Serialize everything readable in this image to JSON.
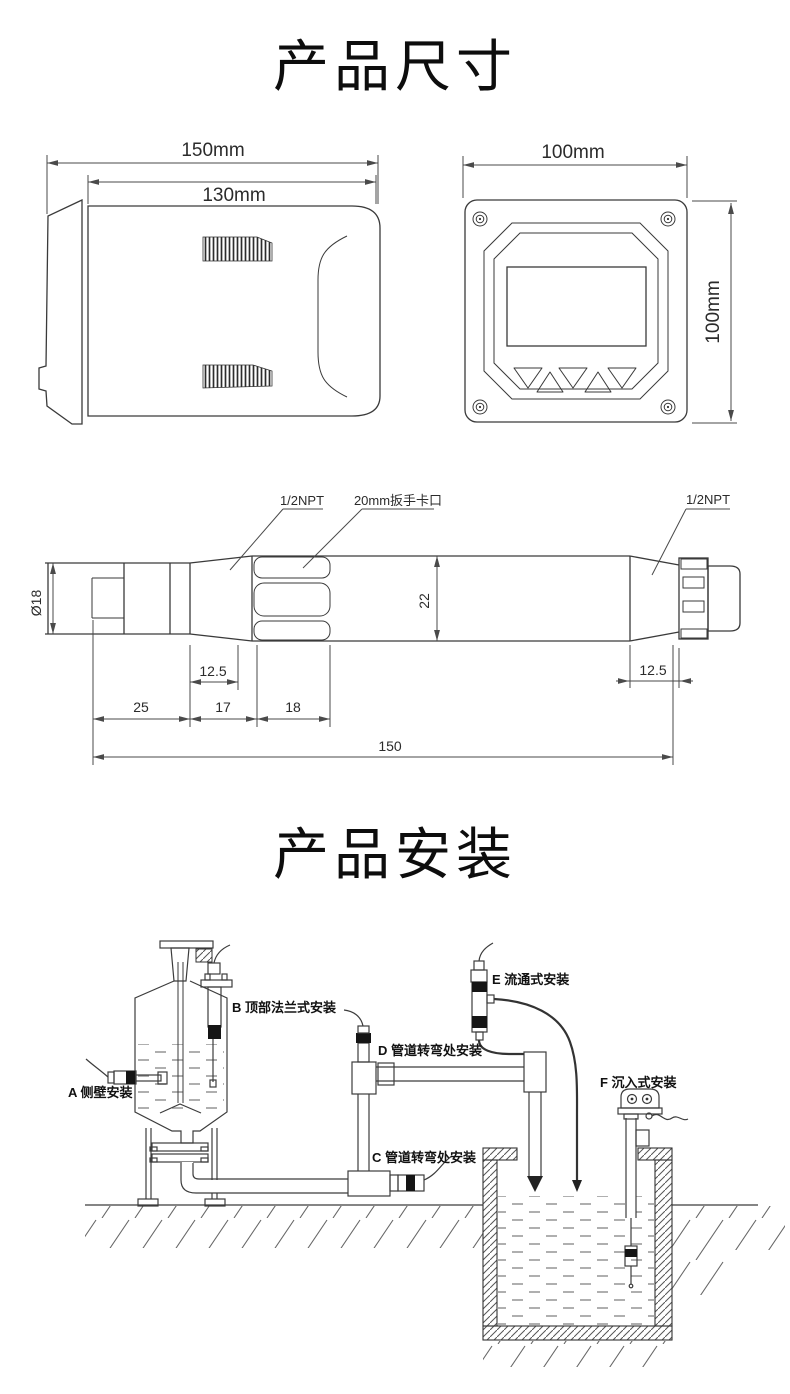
{
  "page": {
    "background": "#ffffff",
    "line_color": "#3a3a3a"
  },
  "dimensions_section": {
    "title": "产品尺寸",
    "controller_side_view": {
      "overall_width": "150mm",
      "body_width": "130mm"
    },
    "controller_front_view": {
      "width": "100mm",
      "height": "100mm"
    },
    "probe_view": {
      "left_thread": "1/2NPT",
      "wrench_slot": "20mm扳手卡口",
      "right_thread": "1/2NPT",
      "tip_diameter": "Ø18",
      "body_diameter": "22",
      "collar_offset": "12.5",
      "tip_length": "25",
      "collar_length": "17",
      "wrench_length": "18",
      "right_offset": "12.5",
      "total_length": "150"
    }
  },
  "installation_section": {
    "title": "产品安装",
    "methods": {
      "a": "A 侧壁安装",
      "b": "B 顶部法兰式安装",
      "c": "C 管道转弯处安装",
      "d": "D 管道转弯处安装",
      "e": "E 流通式安装",
      "f": "F 沉入式安装"
    }
  }
}
